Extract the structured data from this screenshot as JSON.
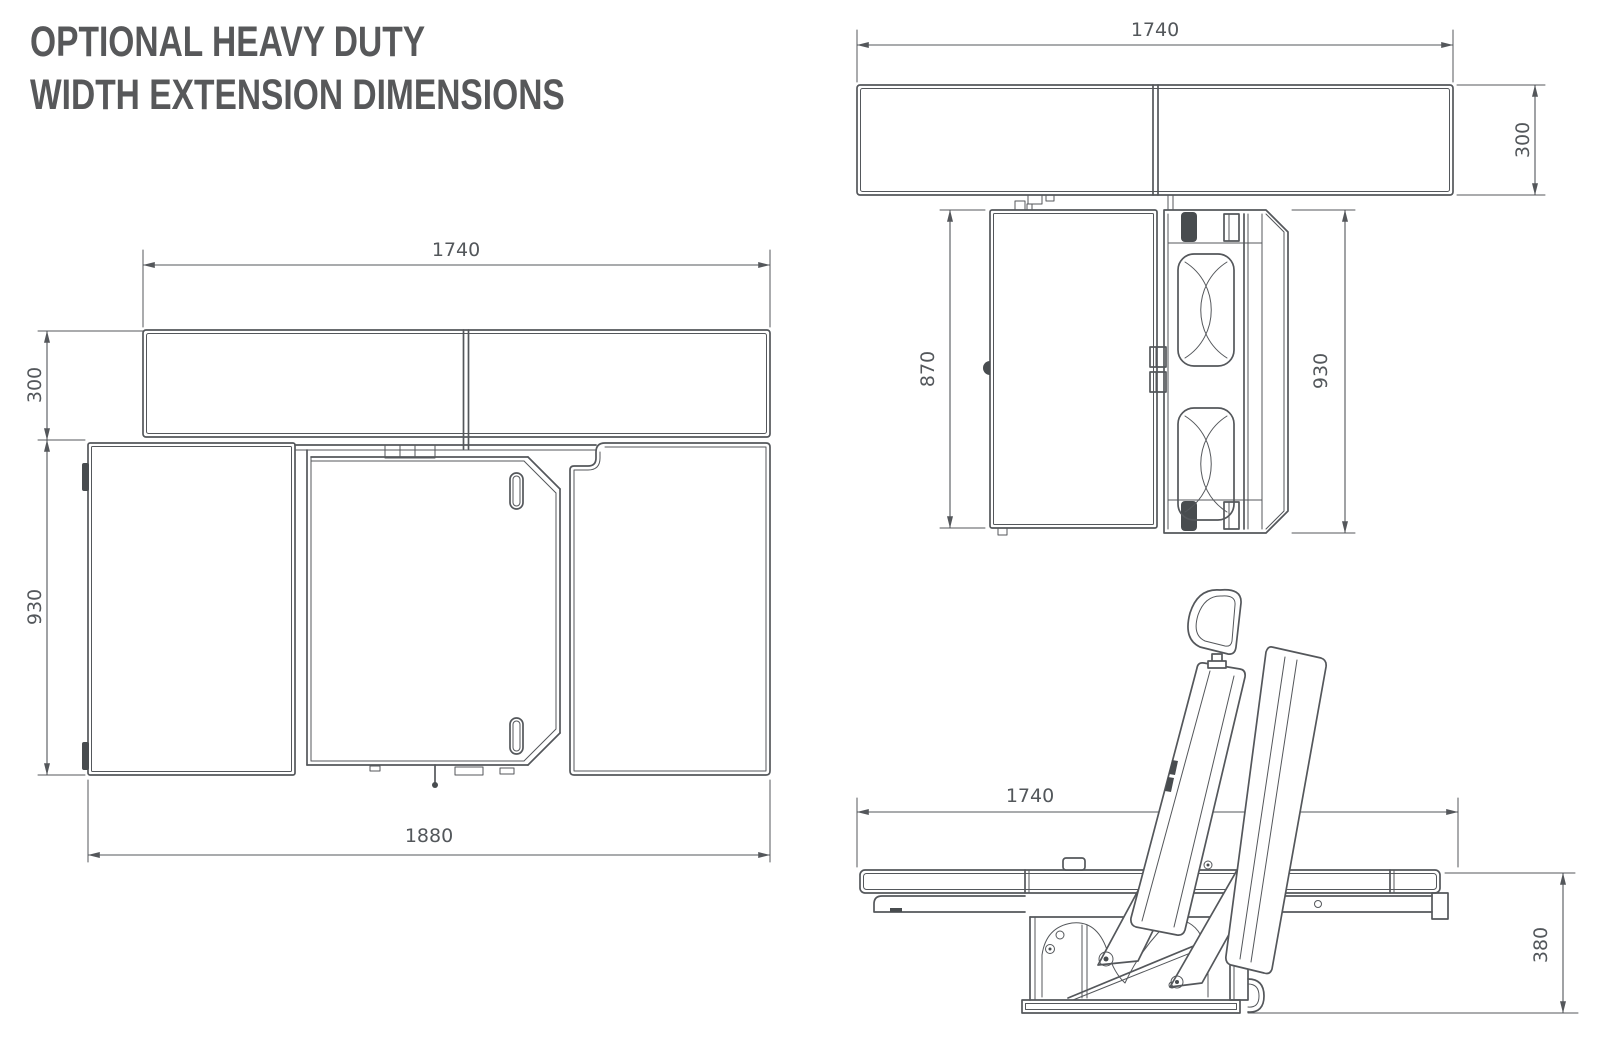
{
  "title": {
    "line1": "OPTIONAL HEAVY DUTY",
    "line2": "WIDTH EXTENSION DIMENSIONS"
  },
  "colors": {
    "background": "#ffffff",
    "line_work": "#54575b",
    "dimension_text": "#53575b",
    "title_text": "#57585a"
  },
  "views": {
    "plan_open": {
      "dims": {
        "backrest_width": "1740",
        "extension_depth": "300",
        "bed_depth": "930",
        "overall_width": "1880"
      }
    },
    "plan_folded": {
      "dims": {
        "backrest_width": "1740",
        "extension_depth": "300",
        "platform_depth": "870",
        "frame_depth": "930"
      }
    },
    "side": {
      "dims": {
        "overall_length": "1740",
        "platform_height": "380"
      }
    }
  }
}
